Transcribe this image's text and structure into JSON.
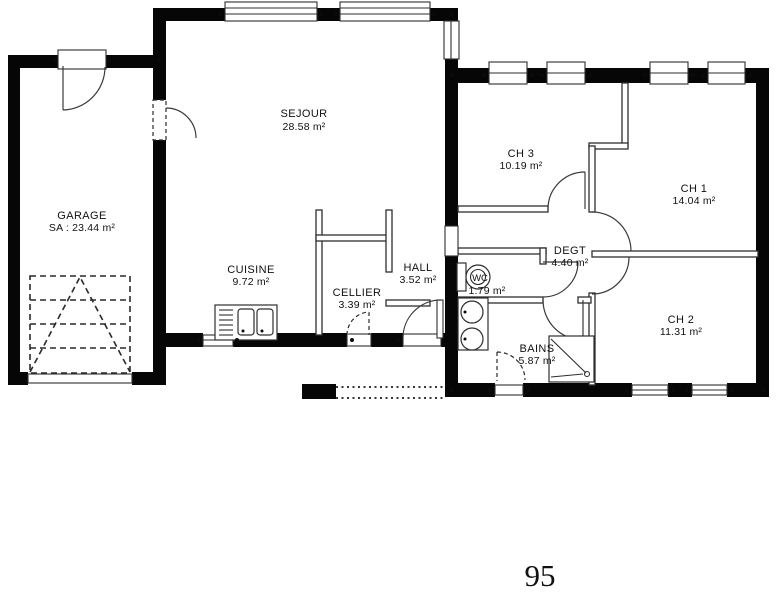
{
  "page_number": "95",
  "colors": {
    "wall": "#060606",
    "line": "#2e2e2e",
    "text": "#111111",
    "background": "#ffffff"
  },
  "rooms": {
    "garage": {
      "name": "GARAGE",
      "area": "SA : 23.44 m²"
    },
    "sejour": {
      "name": "SEJOUR",
      "area": "28.58 m²"
    },
    "cuisine": {
      "name": "CUISINE",
      "area": "9.72 m²"
    },
    "cellier": {
      "name": "CELLIER",
      "area": "3.39 m²"
    },
    "hall": {
      "name": "HALL",
      "area": "3.52 m²"
    },
    "wc": {
      "name": "WC",
      "area": "1.79 m²"
    },
    "degt": {
      "name": "DEGT",
      "area": "4.40 m²"
    },
    "ch1": {
      "name": "CH 1",
      "area": "14.04 m²"
    },
    "ch2": {
      "name": "CH 2",
      "area": "11.31 m²"
    },
    "ch3": {
      "name": "CH 3",
      "area": "10.19 m²"
    },
    "bains": {
      "name": "BAINS",
      "area": "5.87 m²"
    }
  }
}
